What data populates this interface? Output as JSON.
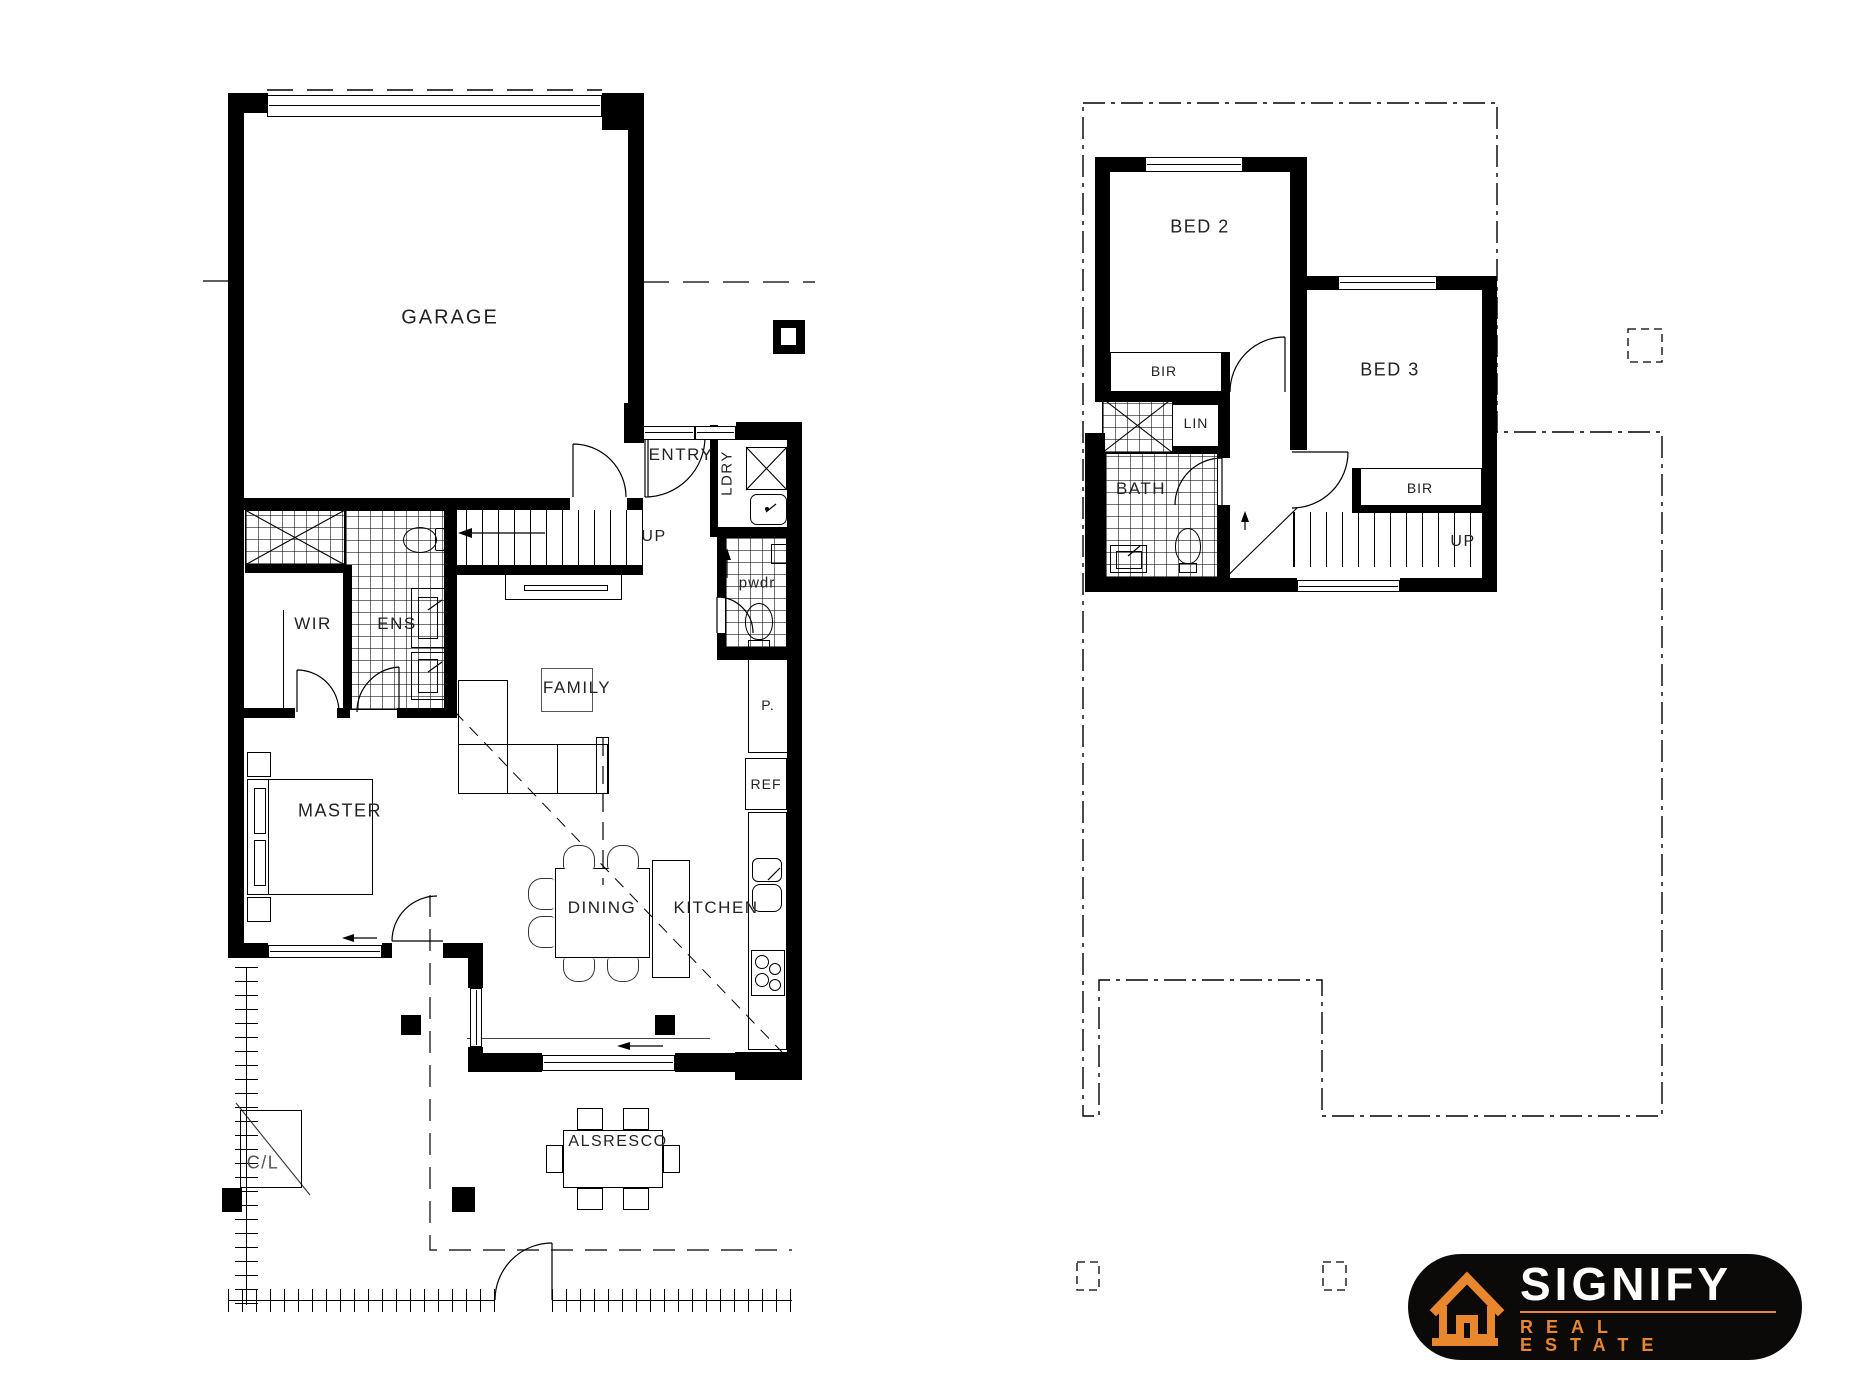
{
  "labels": {
    "ground": {
      "garage": "GARAGE",
      "entry": "ENTRY",
      "laundry": "LDRY",
      "up": "UP",
      "powder": "pwdr",
      "wir": "WIR",
      "ensuite": "ENS",
      "family": "FAMILY",
      "master": "MASTER",
      "dining": "DINING",
      "kitchen": "KITCHEN",
      "pantry": "P.",
      "fridge": "REF",
      "alfresco": "ALSRESCO",
      "clothesline": "C/L"
    },
    "upper": {
      "bed2": "BED 2",
      "bed3": "BED 3",
      "bir2": "BIR",
      "bir3": "BIR",
      "linen": "LIN",
      "bath": "BATH",
      "up": "UP"
    },
    "logo": {
      "brand": "SIGNIFY",
      "tagline": "REAL ESTATE"
    }
  },
  "colors": {
    "accent_orange": "#e8872e",
    "logo_background": "#0c0a08",
    "linework": "#000000"
  }
}
